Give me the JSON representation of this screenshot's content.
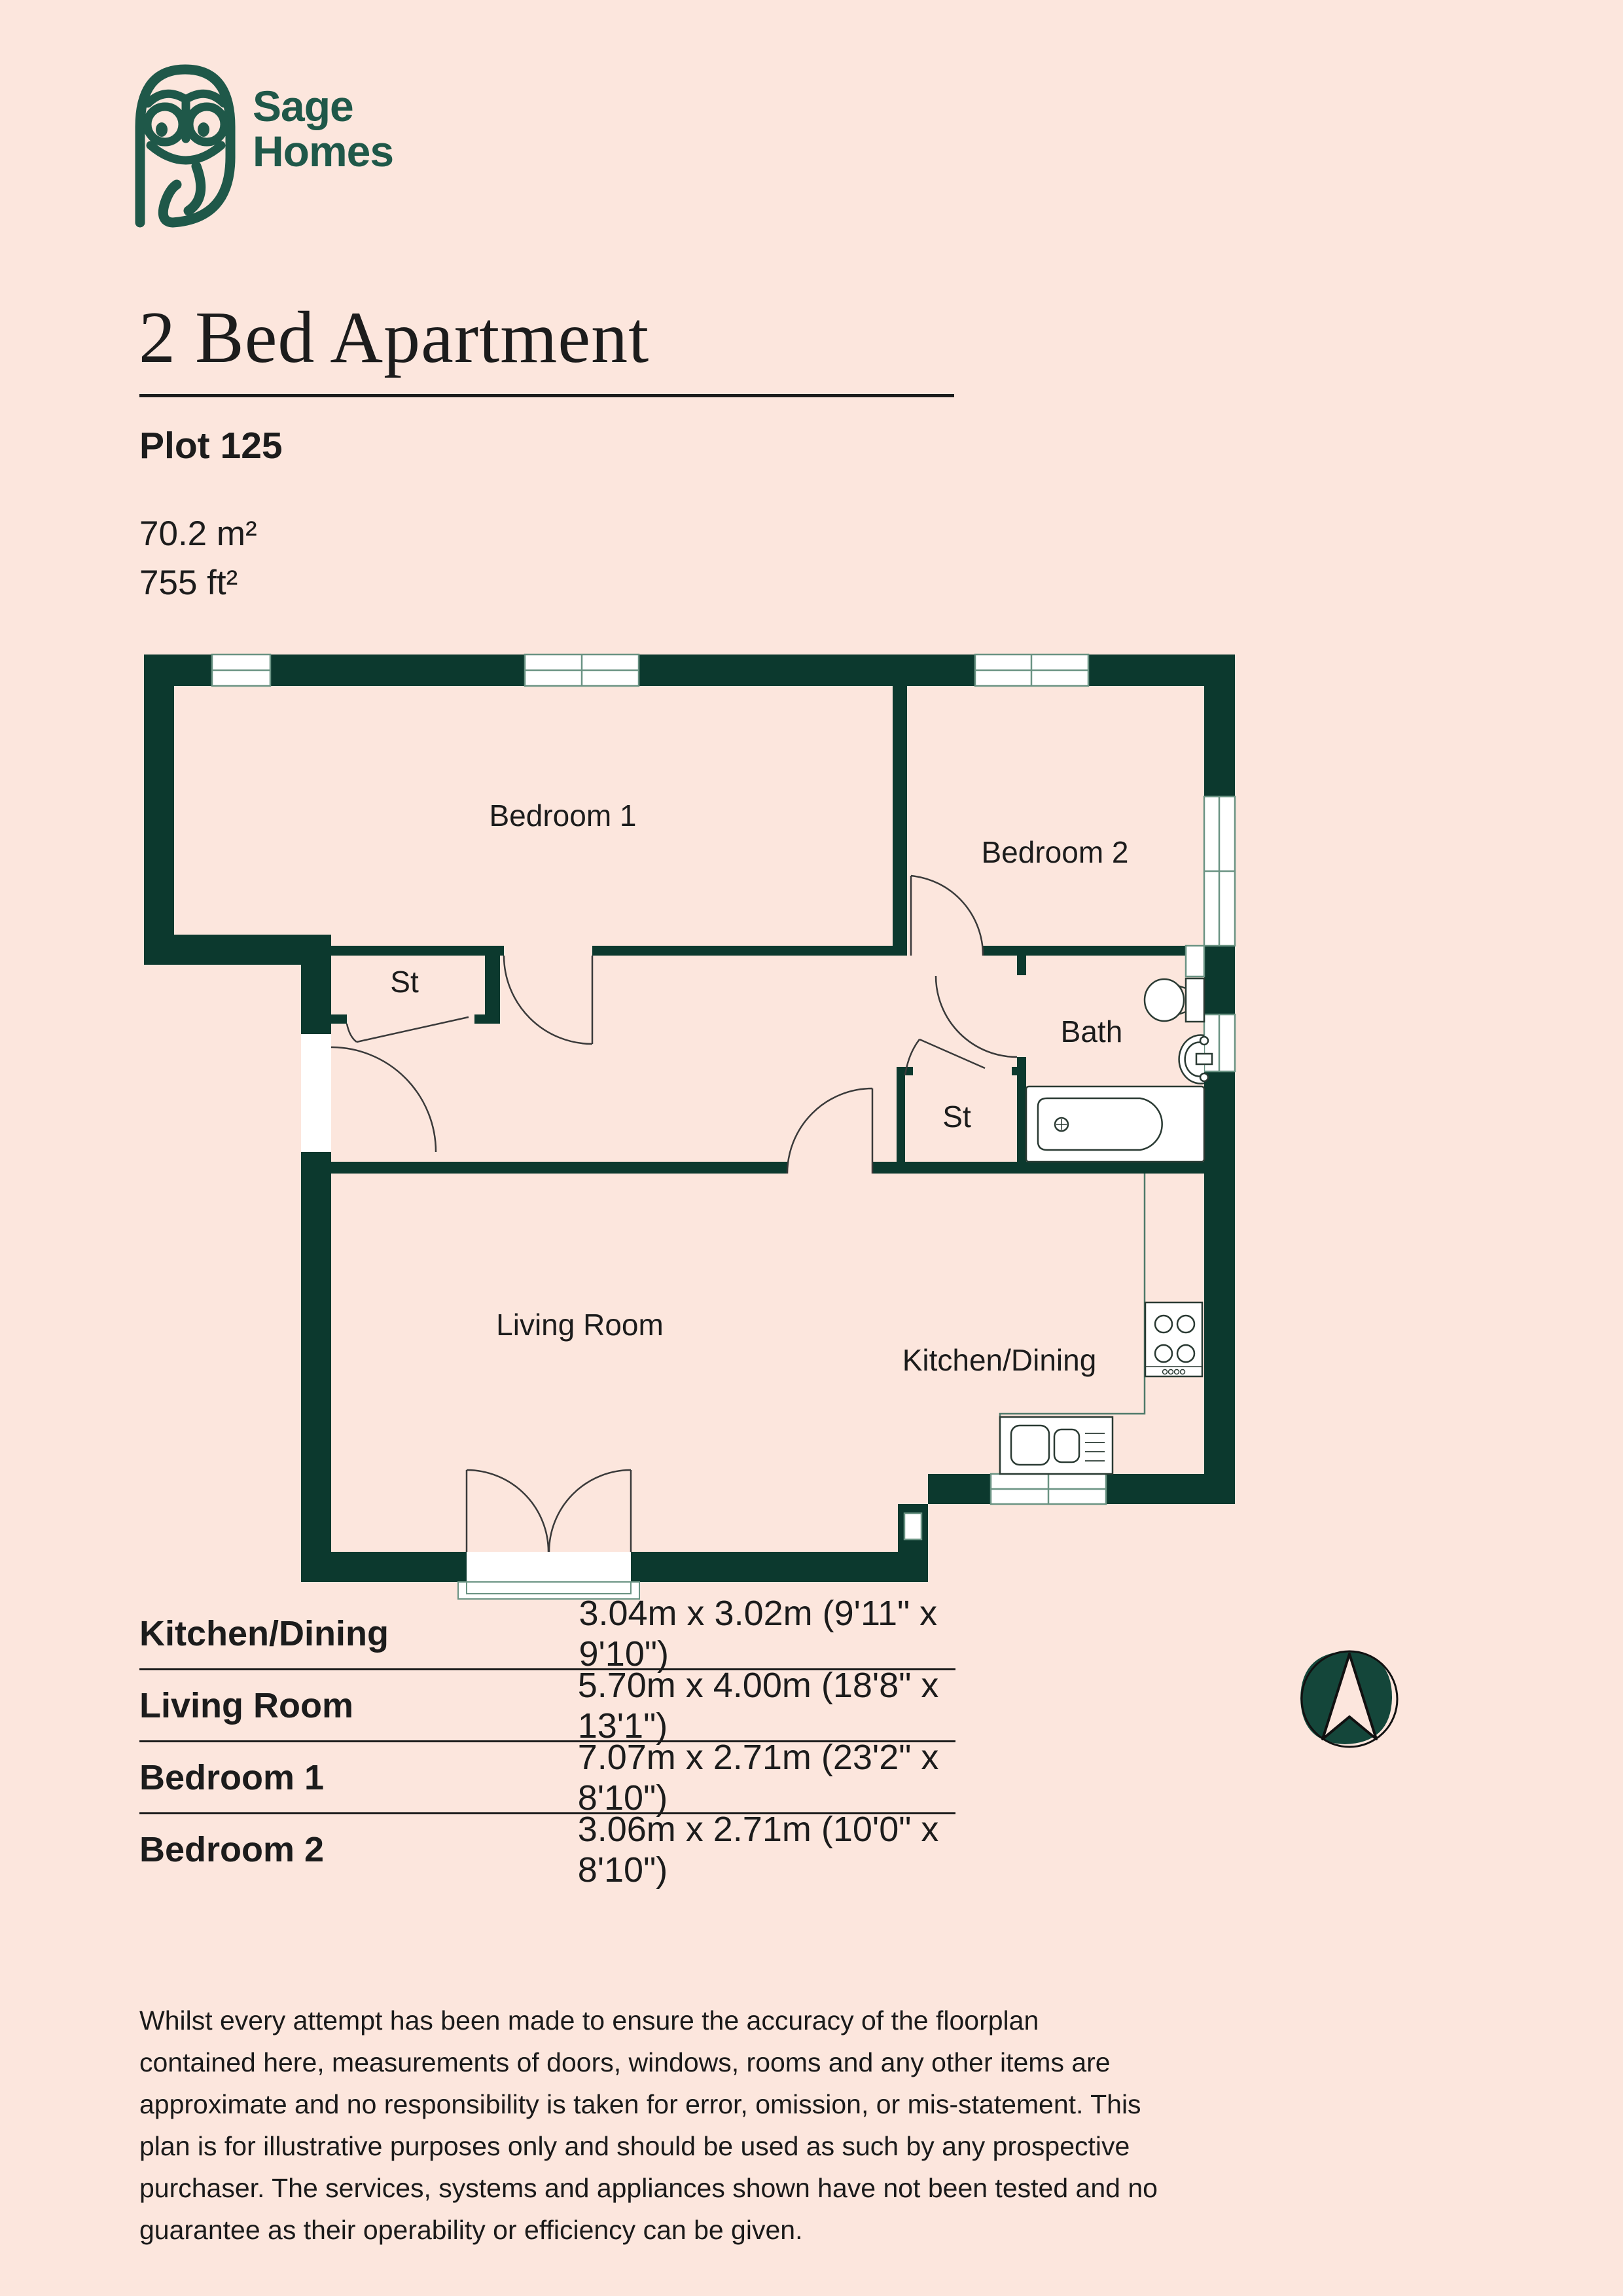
{
  "page": {
    "background": "#fce6dd",
    "ink": "#1c1c1c"
  },
  "brand": {
    "logo_icon": "owl-logo",
    "name_line1": "Sage",
    "name_line2": "Homes",
    "green": "#1f5849"
  },
  "header": {
    "title": "2 Bed Apartment",
    "plot": "Plot 125",
    "area_m2": "70.2 m²",
    "area_ft2": "755 ft²"
  },
  "floorplan": {
    "wall_color": "#0c392e",
    "frame_color": "#6a9383",
    "labels": {
      "bedroom1": "Bedroom 1",
      "bedroom2": "Bedroom 2",
      "bath": "Bath",
      "storage1": "St",
      "storage2": "St",
      "living": "Living Room",
      "kitchen": "Kitchen/Dining"
    }
  },
  "dimensions_table": {
    "rows": [
      {
        "name": "Kitchen/Dining",
        "size": "3.04m x 3.02m (9'11\" x 9'10\")"
      },
      {
        "name": "Living Room",
        "size": "5.70m x 4.00m (18'8\" x 13'1\")"
      },
      {
        "name": "Bedroom 1",
        "size": "7.07m x 2.71m (23'2\" x 8'10\")"
      },
      {
        "name": "Bedroom 2",
        "size": "3.06m x 2.71m (10'0\" x 8'10\")"
      }
    ]
  },
  "compass": {
    "icon": "north-arrow",
    "blob_color": "#14463a"
  },
  "disclaimer": "Whilst every attempt has been made to ensure the accuracy of the floorplan contained here, measurements of doors, windows, rooms and any other items are approximate and no responsibility is taken for error, omission, or mis-statement. This plan is for illustrative purposes only and should be used as such by any prospective purchaser. The services, systems and appliances shown have not been tested and no guarantee as their operability or efficiency can be given."
}
